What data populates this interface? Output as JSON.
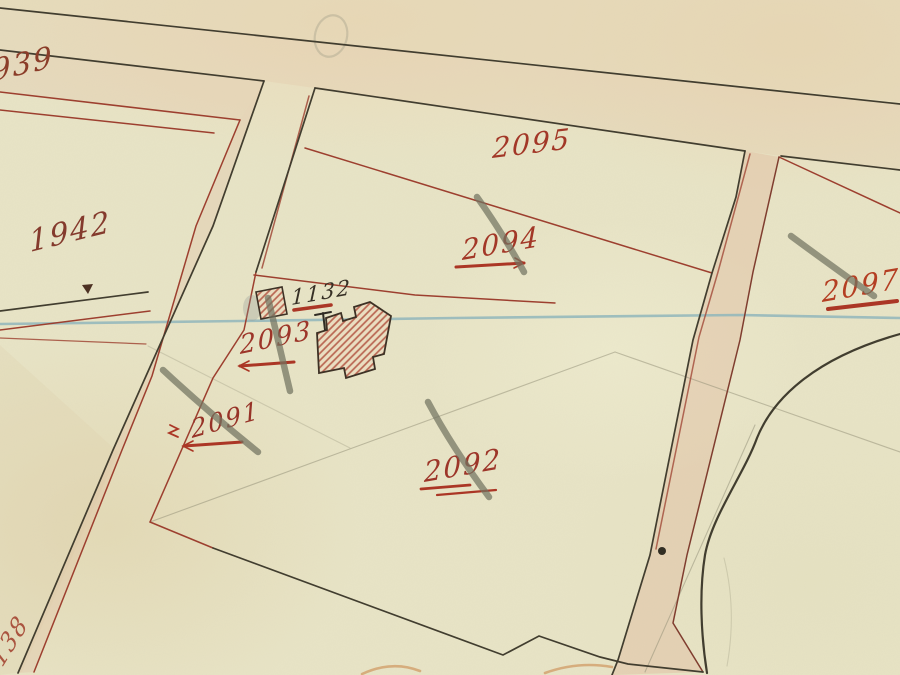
{
  "map": {
    "title": "cadastral plan scan",
    "parcel_labels": [
      {
        "label": "1939",
        "color": "#8a3a26"
      },
      {
        "label": "1942",
        "color": "#83372a"
      },
      {
        "label": "2095",
        "color": "#a23424"
      },
      {
        "label": "2094",
        "color": "#a23424"
      },
      {
        "label": "2093",
        "color": "#9c3226"
      },
      {
        "label": "1132",
        "color": "#332c22"
      },
      {
        "label": "2091",
        "color": "#962f24"
      },
      {
        "label": "2092",
        "color": "#9c3226"
      },
      {
        "label": "2097",
        "color": "#b43b1f"
      },
      {
        "label": "138",
        "color": "#a03a28"
      }
    ],
    "colors": {
      "paper": "#e8e4c6",
      "paper_top_band": "#e5d3b2",
      "ink_black": "#3e3a2c",
      "ink_red": "#9c3c2c",
      "stream_blue": "#8fb6bc",
      "pencil_gray": "#70725f",
      "building_hatch": "#b96450",
      "road_tint": "#dfa98f"
    }
  }
}
